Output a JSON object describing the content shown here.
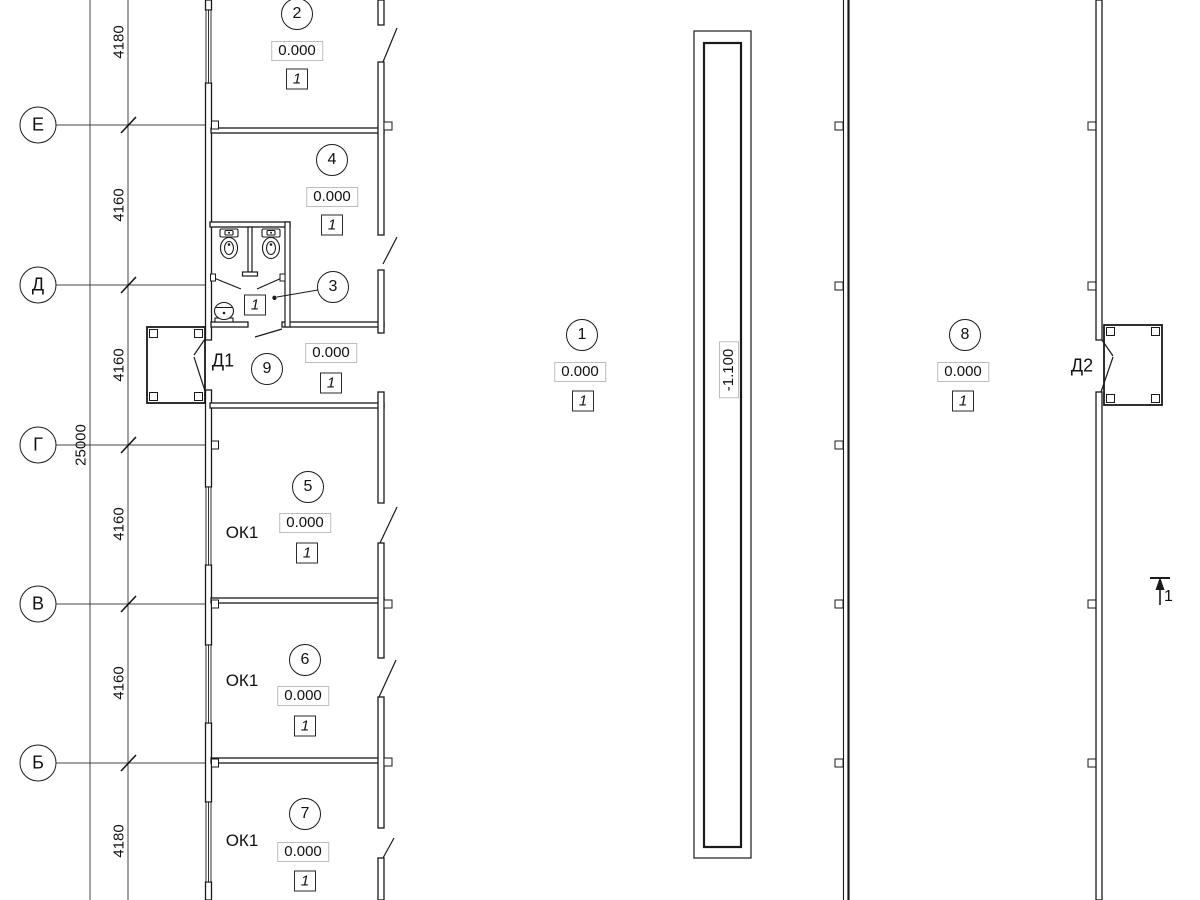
{
  "axes": [
    {
      "label": "Е"
    },
    {
      "label": "Д"
    },
    {
      "label": "Г"
    },
    {
      "label": "В"
    },
    {
      "label": "Б"
    }
  ],
  "dims": {
    "d0": "4180",
    "d1": "4160",
    "d2": "4160",
    "d3": "4160",
    "d4": "4160",
    "d5": "4180",
    "total": "25000"
  },
  "rooms": {
    "r2": {
      "num": "2",
      "elev": "0.000",
      "tag": "1"
    },
    "r4": {
      "num": "4",
      "elev": "0.000",
      "tag": "1"
    },
    "r3": {
      "num": "3"
    },
    "r9": {
      "num": "9",
      "elev": "0.000",
      "tag": "1"
    },
    "r5": {
      "num": "5",
      "elev": "0.000",
      "tag": "1",
      "window": "ОК1"
    },
    "r6": {
      "num": "6",
      "elev": "0.000",
      "tag": "1",
      "window": "ОК1"
    },
    "r7": {
      "num": "7",
      "elev": "0.000",
      "tag": "1",
      "window": "ОК1"
    },
    "r1": {
      "num": "1",
      "elev": "0.000",
      "tag": "1"
    },
    "r8": {
      "num": "8",
      "elev": "0.000",
      "tag": "1"
    }
  },
  "bath": {
    "tag": "1"
  },
  "doors": {
    "d1": "Д1",
    "d2": "Д2"
  },
  "pit": {
    "elev": "-1.100"
  },
  "section": {
    "label": "1"
  },
  "colors": {
    "line": "#1a1a1a",
    "thin": "#444",
    "elev_box_border": "#bdbdbd"
  }
}
